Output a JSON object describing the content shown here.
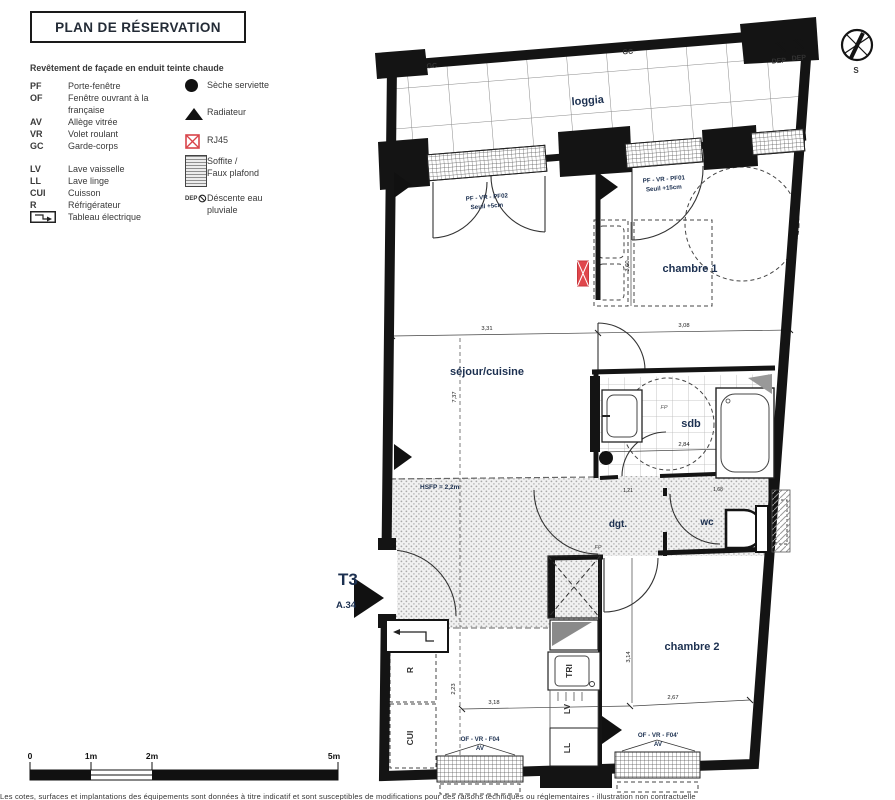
{
  "title": "PLAN DE RÉSERVATION",
  "facade_note": "Revêtement de façade en enduit teinte chaude",
  "legend": {
    "abbreviations": [
      {
        "abbr": "PF",
        "label": "Porte-fenêtre"
      },
      {
        "abbr": "OF",
        "label": "Fenêtre ouvrant à la",
        "label2": "française"
      },
      {
        "abbr": "AV",
        "label": "Allège vitrée"
      },
      {
        "abbr": "VR",
        "label": "Volet roulant"
      },
      {
        "abbr": "GC",
        "label": "Garde-corps"
      },
      {
        "abbr": "LV",
        "label": "Lave vaisselle"
      },
      {
        "abbr": "LL",
        "label": "Lave linge"
      },
      {
        "abbr": "CUI",
        "label": "Cuisson"
      },
      {
        "abbr": "R",
        "label": "Réfrigérateur"
      },
      {
        "abbr": "",
        "label": "Tableau électrique"
      }
    ],
    "symbols": [
      {
        "icon": "dot",
        "label": "Sèche serviette"
      },
      {
        "icon": "triangle",
        "label": "Radiateur"
      },
      {
        "icon": "rj45",
        "label": "RJ45"
      },
      {
        "icon": "hatch",
        "label": "Soffite /",
        "label2": "Faux plafond"
      },
      {
        "icon": "dep",
        "dep_text": "DEP",
        "label": "Déscente eau",
        "label2": "pluviale"
      }
    ]
  },
  "plan": {
    "rooms": {
      "loggia": "loggia",
      "chambre1": "chambre 1",
      "sejour": "séjour/cuisine",
      "sdb": "sdb",
      "dgt": "dgt.",
      "wc": "wc",
      "chambre2": "chambre 2"
    },
    "unit": {
      "type": "T3",
      "lot": "A.34"
    },
    "windows": {
      "pf02": "PF - VR - PF02",
      "pf02_seuil": "Seuil +5cm",
      "pf01": "PF - VR - PF01",
      "pf01_seuil": "Seuil +15cm",
      "f04": "OF - VR - F04",
      "f04_av": "AV",
      "f04b": "OF - VR - F04'",
      "f04b_av": "AV"
    },
    "annotations": {
      "gc1": "GC",
      "gc2": "GC",
      "dep1": "DEP",
      "dep2": "DEP",
      "hsfp": "HSFP = 2,2m",
      "fp": "FP",
      "fp2": "FP",
      "compass": "S"
    },
    "appliances": {
      "r": "R",
      "cui": "CUI",
      "tri": "TRI",
      "lv": "LV",
      "ll": "LL"
    },
    "dimensions": {
      "sejour_w": "3,31",
      "chambre1_w": "3,08",
      "sejour_h": "7,37",
      "chambre1_h": "3,60",
      "sdb_w": "2,84",
      "kitchen_h": "2,23",
      "kitchen_w": "3,18",
      "chambre2_h": "3,14",
      "chambre2_w": "2,67",
      "dgt_w": "1,21",
      "wc_w": "1,68"
    }
  },
  "scalebar": {
    "t0": "0",
    "t1": "1m",
    "t2": "2m",
    "t5": "5m"
  },
  "footer": {
    "disclaimer": "Les cotes, surfaces et implantations des équipements sont données à titre indicatif et sont susceptibles de modifications pour des raisons techniques ou réglementaires - illustration non contractuelle"
  },
  "colors": {
    "navy": "#1c3050",
    "red": "#e0474c",
    "ink": "#141414",
    "text": "#3a3a3a"
  }
}
